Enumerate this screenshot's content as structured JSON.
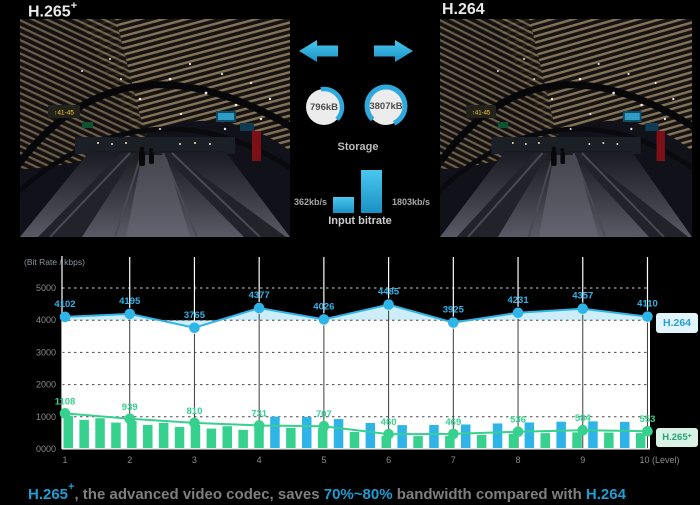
{
  "titles": {
    "left_base": "H.265",
    "left_sup": "+",
    "right": "H.264"
  },
  "photo": {
    "gate_sign": "↑41-45"
  },
  "comparison": {
    "storage": {
      "label": "Storage",
      "h265_value": "796kB",
      "h264_value": "3807kB"
    },
    "input_bitrate": {
      "label": "Input bitrate",
      "h265_value": "362kb/s",
      "h264_value": "1803kb/s"
    }
  },
  "legend": {
    "h264": "H.264",
    "h265_base": "H.265",
    "h265_sup": "+"
  },
  "caption": {
    "h265_base": "H.265",
    "h265_sup": "+",
    "mid1": ", the advanced video codec, saves ",
    "highlight": "70%~80%",
    "mid2": " bandwidth compared with ",
    "h264": "H.264"
  },
  "chart_data": {
    "type": "line",
    "title": "",
    "ylabel": "(Bit Rate / kbps)",
    "x": [
      1,
      2,
      3,
      4,
      5,
      6,
      7,
      8,
      9,
      10
    ],
    "x_labels": [
      "1",
      "2",
      "3",
      "4",
      "5",
      "6",
      "7",
      "8",
      "9",
      "10 (Level)"
    ],
    "yticks_values": [
      5000,
      4000,
      3000,
      2000,
      1000,
      0
    ],
    "ytick_labels": [
      "5000",
      "4000",
      "3000",
      "2000",
      "1000",
      "0000"
    ],
    "ylim": [
      0,
      5400
    ],
    "grid": "dashed-horizontal",
    "legend_position": "right",
    "series": [
      {
        "name": "H.264",
        "color": "#2fb4e8",
        "values": [
          4102,
          4195,
          3765,
          4377,
          4026,
          4485,
          3925,
          4231,
          4357,
          4110
        ]
      },
      {
        "name": "H.265+",
        "color": "#36d18e",
        "values": [
          1108,
          939,
          810,
          731,
          707,
          460,
          469,
          536,
          584,
          553
        ]
      }
    ],
    "colors": {
      "white_area": "#ffffff",
      "cyan_band": "#cdeef9",
      "grid_dark": "#4a4a4a",
      "grid_light": "#cfcfcf",
      "axis": "#d9d9d9",
      "tick_text": "#8a8a8a",
      "bar_green": "#36d18e",
      "bar_blue": "#2fb4e8"
    }
  }
}
